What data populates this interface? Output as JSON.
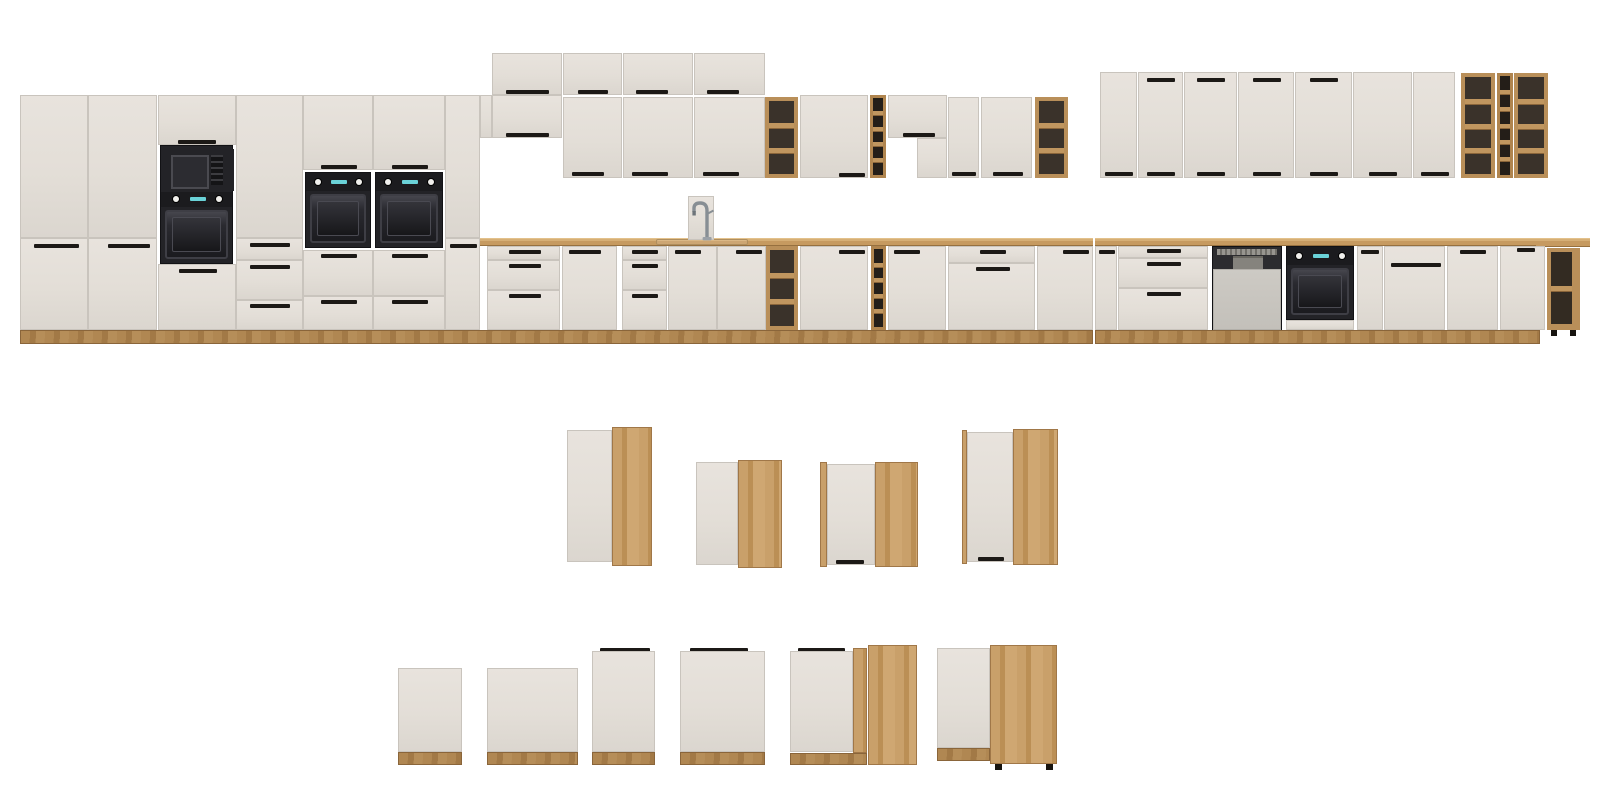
{
  "meta": {
    "scene": "kitchen-cabinet-modular-lineup-render",
    "width": 1600,
    "height": 807
  },
  "palette": {
    "background": "#ffffff",
    "front": "#e3ded7",
    "front_edge": "#c9c4bd",
    "wood_oak": "#c49a62",
    "countertop": "#c69a60",
    "plinth": "#a87f4e",
    "shelf_interior": "#3a322a",
    "winerack_interior": "#241e18",
    "handle": "#1c1916",
    "appliance_dark": "#232327",
    "oven_window": "#1b1b1f",
    "knob": "#f0efec",
    "display_cyan": "#6ad2d8",
    "dishwasher_panel": "#c9c6c0",
    "chrome": "#8e959b"
  },
  "modules": [
    {
      "n": "tall-side-panel",
      "t": "sidepanel",
      "x": 480,
      "y": 95,
      "w": 12,
      "h": 43
    },
    {
      "n": "tall-door",
      "t": "panel",
      "x": 20,
      "y": 95,
      "w": 68,
      "h": 143
    },
    {
      "n": "tall-door",
      "t": "panel",
      "x": 20,
      "y": 238,
      "w": 68,
      "h": 92,
      "hd": [
        [
          13,
          5,
          45
        ]
      ]
    },
    {
      "n": "tall-door",
      "t": "panel",
      "x": 88,
      "y": 95,
      "w": 69,
      "h": 143
    },
    {
      "n": "tall-door",
      "t": "panel",
      "x": 88,
      "y": 238,
      "w": 69,
      "h": 92,
      "hd": [
        [
          19,
          5,
          42
        ]
      ]
    },
    {
      "n": "tall-door",
      "t": "panel",
      "x": 158,
      "y": 95,
      "w": 78,
      "h": 50,
      "hd": [
        [
          19,
          44,
          38
        ]
      ]
    },
    {
      "n": "microwave-oven-tower",
      "t": "mt",
      "x": 160,
      "y": 145,
      "w": 73,
      "h": 119
    },
    {
      "n": "drawer-front",
      "t": "panel",
      "x": 158,
      "y": 264,
      "w": 78,
      "h": 66,
      "hd": [
        [
          20,
          4,
          38
        ]
      ]
    },
    {
      "n": "tall-door",
      "t": "panel",
      "x": 236,
      "y": 95,
      "w": 67,
      "h": 143
    },
    {
      "n": "drawer-front",
      "t": "panel",
      "x": 236,
      "y": 238,
      "w": 67,
      "h": 22,
      "hd": [
        [
          13,
          4,
          40
        ]
      ]
    },
    {
      "n": "drawer-front",
      "t": "panel",
      "x": 236,
      "y": 260,
      "w": 67,
      "h": 40,
      "hd": [
        [
          13,
          4,
          40
        ]
      ]
    },
    {
      "n": "drawer-front",
      "t": "panel",
      "x": 236,
      "y": 300,
      "w": 67,
      "h": 30,
      "hd": [
        [
          13,
          3,
          40
        ]
      ]
    },
    {
      "n": "tall-door",
      "t": "panel",
      "x": 303,
      "y": 95,
      "w": 70,
      "h": 75,
      "hd": [
        [
          17,
          69,
          36
        ]
      ]
    },
    {
      "n": "built-in-oven",
      "t": "ov",
      "x": 305,
      "y": 172,
      "w": 66,
      "h": 76
    },
    {
      "n": "drawer-front",
      "t": "panel",
      "x": 303,
      "y": 250,
      "w": 70,
      "h": 46,
      "hd": [
        [
          17,
          3,
          36
        ]
      ]
    },
    {
      "n": "drawer-front",
      "t": "panel",
      "x": 303,
      "y": 296,
      "w": 70,
      "h": 34,
      "hd": [
        [
          17,
          3,
          36
        ]
      ]
    },
    {
      "n": "tall-door",
      "t": "panel",
      "x": 373,
      "y": 95,
      "w": 72,
      "h": 75,
      "hd": [
        [
          18,
          69,
          36
        ]
      ]
    },
    {
      "n": "built-in-oven",
      "t": "ov",
      "x": 375,
      "y": 172,
      "w": 68,
      "h": 76
    },
    {
      "n": "drawer-front",
      "t": "panel",
      "x": 373,
      "y": 250,
      "w": 72,
      "h": 46,
      "hd": [
        [
          18,
          3,
          36
        ]
      ]
    },
    {
      "n": "drawer-front",
      "t": "panel",
      "x": 373,
      "y": 296,
      "w": 72,
      "h": 34,
      "hd": [
        [
          18,
          3,
          36
        ]
      ]
    },
    {
      "n": "tall-door",
      "t": "panel",
      "x": 445,
      "y": 95,
      "w": 35,
      "h": 143
    },
    {
      "n": "tall-door",
      "t": "panel",
      "x": 445,
      "y": 238,
      "w": 35,
      "h": 92,
      "hd": [
        [
          4,
          5,
          27
        ]
      ]
    },
    {
      "n": "wall-topper-door",
      "t": "panel",
      "x": 492,
      "y": 53,
      "w": 70,
      "h": 42,
      "hd": [
        [
          13,
          36,
          43
        ]
      ]
    },
    {
      "n": "wall-topper-door",
      "t": "panel",
      "x": 563,
      "y": 53,
      "w": 59,
      "h": 42,
      "hd": [
        [
          14,
          36,
          30
        ]
      ]
    },
    {
      "n": "wall-topper-door",
      "t": "panel",
      "x": 623,
      "y": 53,
      "w": 70,
      "h": 42,
      "hd": [
        [
          12,
          36,
          32
        ]
      ]
    },
    {
      "n": "wall-topper-door",
      "t": "panel",
      "x": 694,
      "y": 53,
      "w": 71,
      "h": 42,
      "hd": [
        [
          12,
          36,
          32
        ]
      ]
    },
    {
      "n": "wall-short-door",
      "t": "panel",
      "x": 492,
      "y": 95,
      "w": 70,
      "h": 43,
      "hd": [
        [
          13,
          37,
          43
        ]
      ]
    },
    {
      "n": "wall-door",
      "t": "panel",
      "x": 563,
      "y": 97,
      "w": 59,
      "h": 81,
      "hd": [
        [
          8,
          74,
          32
        ]
      ]
    },
    {
      "n": "wall-door",
      "t": "panel",
      "x": 623,
      "y": 97,
      "w": 70,
      "h": 81,
      "hd": [
        [
          8,
          74,
          36
        ]
      ]
    },
    {
      "n": "wall-door",
      "t": "panel",
      "x": 694,
      "y": 97,
      "w": 71,
      "h": 81,
      "hd": [
        [
          8,
          74,
          36
        ]
      ]
    },
    {
      "n": "wall-open-shelf",
      "t": "sh",
      "x": 765,
      "y": 97,
      "w": 33,
      "h": 81,
      "c": 3
    },
    {
      "n": "wall-door",
      "t": "panel",
      "x": 800,
      "y": 95,
      "w": 68,
      "h": 83,
      "hd": [
        [
          38,
          77,
          26
        ]
      ]
    },
    {
      "n": "wall-wine-rack",
      "t": "wr",
      "x": 870,
      "y": 95,
      "w": 16,
      "h": 83,
      "c": 5
    },
    {
      "n": "hood-cabinet-door",
      "t": "panel",
      "x": 888,
      "y": 95,
      "w": 59,
      "h": 43,
      "hd": [
        [
          14,
          37,
          32
        ]
      ]
    },
    {
      "n": "hood-cabinet-side",
      "t": "panel",
      "x": 917,
      "y": 138,
      "w": 30,
      "h": 40
    },
    {
      "n": "wall-door",
      "t": "panel",
      "x": 948,
      "y": 97,
      "w": 31,
      "h": 81,
      "hd": [
        [
          3,
          74,
          24
        ]
      ]
    },
    {
      "n": "wall-door",
      "t": "panel",
      "x": 981,
      "y": 97,
      "w": 51,
      "h": 81,
      "hd": [
        [
          11,
          74,
          30
        ]
      ]
    },
    {
      "n": "wall-open-shelf",
      "t": "sh",
      "x": 1035,
      "y": 97,
      "w": 33,
      "h": 81,
      "c": 3
    },
    {
      "n": "wall-door",
      "t": "panel",
      "x": 1100,
      "y": 72,
      "w": 37,
      "h": 106,
      "hd": [
        [
          4,
          99,
          28
        ]
      ]
    },
    {
      "n": "wall-door",
      "t": "panel",
      "x": 1138,
      "y": 72,
      "w": 45,
      "h": 106,
      "hd": [
        [
          8,
          99,
          28
        ],
        [
          8,
          5,
          28
        ]
      ]
    },
    {
      "n": "wall-door",
      "t": "panel",
      "x": 1184,
      "y": 72,
      "w": 53,
      "h": 106,
      "hd": [
        [
          12,
          99,
          28
        ],
        [
          12,
          5,
          28
        ]
      ]
    },
    {
      "n": "wall-door",
      "t": "panel",
      "x": 1238,
      "y": 72,
      "w": 56,
      "h": 106,
      "hd": [
        [
          14,
          99,
          28
        ],
        [
          14,
          5,
          28
        ]
      ]
    },
    {
      "n": "wall-door",
      "t": "panel",
      "x": 1295,
      "y": 72,
      "w": 57,
      "h": 106,
      "hd": [
        [
          14,
          99,
          28
        ],
        [
          14,
          5,
          28
        ]
      ]
    },
    {
      "n": "wall-door",
      "t": "panel",
      "x": 1353,
      "y": 72,
      "w": 59,
      "h": 106,
      "hd": [
        [
          15,
          99,
          28
        ]
      ]
    },
    {
      "n": "wall-door",
      "t": "panel",
      "x": 1413,
      "y": 72,
      "w": 42,
      "h": 106,
      "hd": [
        [
          7,
          99,
          28
        ]
      ]
    },
    {
      "n": "wall-open-shelf",
      "t": "sh",
      "x": 1461,
      "y": 73,
      "w": 34,
      "h": 105,
      "c": 4
    },
    {
      "n": "wall-wine-rack",
      "t": "wr",
      "x": 1497,
      "y": 73,
      "w": 16,
      "h": 105,
      "c": 6
    },
    {
      "n": "wall-open-shelf",
      "t": "sh",
      "x": 1514,
      "y": 73,
      "w": 34,
      "h": 105,
      "c": 4
    },
    {
      "n": "countertop",
      "t": "ct",
      "x": 480,
      "y": 238,
      "w": 613,
      "h": 8
    },
    {
      "n": "countertop",
      "t": "ct",
      "x": 1095,
      "y": 238,
      "w": 445,
      "h": 8
    },
    {
      "n": "corner-countertop",
      "t": "ct",
      "x": 1536,
      "y": 238,
      "w": 54,
      "h": 9
    },
    {
      "n": "sink-rim",
      "t": "sk",
      "x": 656,
      "y": 239,
      "w": 92,
      "h": 6
    },
    {
      "n": "faucet",
      "t": "fc",
      "x": 688,
      "y": 196,
      "w": 26,
      "h": 44
    },
    {
      "n": "drawer-front",
      "t": "panel",
      "x": 487,
      "y": 246,
      "w": 73,
      "h": 14,
      "hd": [
        [
          21,
          3,
          32
        ]
      ]
    },
    {
      "n": "drawer-front",
      "t": "panel",
      "x": 487,
      "y": 260,
      "w": 73,
      "h": 30,
      "hd": [
        [
          21,
          3,
          32
        ]
      ]
    },
    {
      "n": "drawer-front",
      "t": "panel",
      "x": 487,
      "y": 290,
      "w": 73,
      "h": 40,
      "hd": [
        [
          21,
          3,
          32
        ]
      ]
    },
    {
      "n": "base-door",
      "t": "panel",
      "x": 562,
      "y": 246,
      "w": 55,
      "h": 84,
      "hd": [
        [
          6,
          3,
          32
        ]
      ]
    },
    {
      "n": "drawer-front",
      "t": "panel",
      "x": 622,
      "y": 246,
      "w": 45,
      "h": 14,
      "hd": [
        [
          9,
          3,
          26
        ]
      ]
    },
    {
      "n": "drawer-front",
      "t": "panel",
      "x": 622,
      "y": 260,
      "w": 45,
      "h": 30,
      "hd": [
        [
          9,
          3,
          26
        ]
      ]
    },
    {
      "n": "drawer-front",
      "t": "panel",
      "x": 622,
      "y": 290,
      "w": 45,
      "h": 40,
      "hd": [
        [
          9,
          3,
          26
        ]
      ]
    },
    {
      "n": "sink-base-door",
      "t": "panel",
      "x": 668,
      "y": 246,
      "w": 49,
      "h": 84,
      "hd": [
        [
          6,
          3,
          26
        ]
      ]
    },
    {
      "n": "sink-base-door",
      "t": "panel",
      "x": 717,
      "y": 246,
      "w": 49,
      "h": 84,
      "hd": [
        [
          18,
          3,
          26
        ]
      ]
    },
    {
      "n": "base-open-shelf",
      "t": "sh",
      "x": 766,
      "y": 246,
      "w": 32,
      "h": 84,
      "c": 3
    },
    {
      "n": "base-door",
      "t": "panel",
      "x": 800,
      "y": 246,
      "w": 68,
      "h": 84,
      "hd": [
        [
          38,
          3,
          26
        ]
      ]
    },
    {
      "n": "base-wine-rack",
      "t": "wr",
      "x": 871,
      "y": 246,
      "w": 15,
      "h": 84,
      "c": 5
    },
    {
      "n": "base-door",
      "t": "panel",
      "x": 888,
      "y": 246,
      "w": 58,
      "h": 84,
      "hd": [
        [
          5,
          3,
          26
        ]
      ]
    },
    {
      "n": "drawer-front",
      "t": "panel",
      "x": 948,
      "y": 246,
      "w": 87,
      "h": 17,
      "hd": [
        [
          31,
          3,
          26
        ]
      ]
    },
    {
      "n": "base-front",
      "t": "panel",
      "x": 948,
      "y": 263,
      "w": 87,
      "h": 67,
      "hd": [
        [
          27,
          3,
          34
        ]
      ]
    },
    {
      "n": "base-door",
      "t": "panel",
      "x": 1037,
      "y": 246,
      "w": 56,
      "h": 84,
      "hd": [
        [
          25,
          3,
          26
        ]
      ]
    },
    {
      "n": "base-door",
      "t": "panel",
      "x": 1095,
      "y": 246,
      "w": 22,
      "h": 84,
      "hd": [
        [
          3,
          3,
          16
        ]
      ]
    },
    {
      "n": "drawer-front",
      "t": "panel",
      "x": 1118,
      "y": 246,
      "w": 90,
      "h": 12,
      "hd": [
        [
          28,
          2,
          34
        ]
      ]
    },
    {
      "n": "drawer-front",
      "t": "panel",
      "x": 1118,
      "y": 258,
      "w": 90,
      "h": 30,
      "hd": [
        [
          28,
          3,
          34
        ]
      ]
    },
    {
      "n": "drawer-front",
      "t": "panel",
      "x": 1118,
      "y": 288,
      "w": 90,
      "h": 42,
      "hd": [
        [
          28,
          3,
          34
        ]
      ]
    },
    {
      "n": "dishwasher",
      "t": "dw",
      "x": 1212,
      "y": 246,
      "w": 70,
      "h": 85
    },
    {
      "n": "built-in-oven",
      "t": "ov",
      "x": 1286,
      "y": 246,
      "w": 68,
      "h": 74
    },
    {
      "n": "base-front",
      "t": "panel",
      "x": 1286,
      "y": 320,
      "w": 68,
      "h": 10
    },
    {
      "n": "base-door",
      "t": "panel",
      "x": 1357,
      "y": 246,
      "w": 26,
      "h": 84,
      "hd": [
        [
          3,
          3,
          18
        ]
      ]
    },
    {
      "n": "appliance-front-panel",
      "t": "panel",
      "x": 1384,
      "y": 246,
      "w": 61,
      "h": 84,
      "hd": [
        [
          6,
          16,
          50
        ]
      ]
    },
    {
      "n": "base-door",
      "t": "panel",
      "x": 1447,
      "y": 246,
      "w": 51,
      "h": 84,
      "hd": [
        [
          12,
          3,
          26
        ]
      ]
    },
    {
      "n": "base-door",
      "t": "panel",
      "x": 1500,
      "y": 246,
      "w": 45,
      "h": 84,
      "hd": [
        [
          16,
          1,
          18
        ]
      ]
    },
    {
      "n": "corner-open-shelf",
      "t": "cs",
      "x": 1547,
      "y": 248,
      "w": 33,
      "h": 82,
      "c": 2
    },
    {
      "n": "adjustable-foot",
      "t": "ft",
      "x": 1551,
      "y": 330,
      "w": 6,
      "h": 6
    },
    {
      "n": "adjustable-foot",
      "t": "ft",
      "x": 1570,
      "y": 330,
      "w": 6,
      "h": 6
    },
    {
      "n": "plinth",
      "t": "pl",
      "x": 20,
      "y": 330,
      "w": 1073,
      "h": 14
    },
    {
      "n": "plinth",
      "t": "pl",
      "x": 1095,
      "y": 330,
      "w": 445,
      "h": 14
    },
    {
      "n": "corner-wall-wood-panel",
      "t": "woodv",
      "x": 612,
      "y": 427,
      "w": 40,
      "h": 139
    },
    {
      "n": "corner-wall-door",
      "t": "panel",
      "x": 567,
      "y": 430,
      "w": 45,
      "h": 132
    },
    {
      "n": "corner-wall-door",
      "t": "panel",
      "x": 696,
      "y": 462,
      "w": 42,
      "h": 103
    },
    {
      "n": "corner-wall-wood-panel",
      "t": "woodv",
      "x": 738,
      "y": 460,
      "w": 44,
      "h": 108
    },
    {
      "n": "corner-wall-wood-strip",
      "t": "woodv",
      "x": 820,
      "y": 462,
      "w": 7,
      "h": 105
    },
    {
      "n": "corner-wall-door",
      "t": "panel",
      "x": 827,
      "y": 464,
      "w": 48,
      "h": 101,
      "hd": [
        [
          8,
          95,
          28
        ]
      ]
    },
    {
      "n": "corner-wall-wood-panel",
      "t": "woodv",
      "x": 875,
      "y": 462,
      "w": 43,
      "h": 105
    },
    {
      "n": "corner-wall-wood-strip",
      "t": "woodv",
      "x": 962,
      "y": 430,
      "w": 5,
      "h": 134
    },
    {
      "n": "corner-wall-door",
      "t": "panel",
      "x": 967,
      "y": 432,
      "w": 46,
      "h": 130,
      "hd": [
        [
          10,
          124,
          26
        ]
      ]
    },
    {
      "n": "corner-wall-wood-panel",
      "t": "woodv",
      "x": 1013,
      "y": 429,
      "w": 45,
      "h": 136
    },
    {
      "n": "appliance-front-panel",
      "t": "panel",
      "x": 398,
      "y": 668,
      "w": 64,
      "h": 84
    },
    {
      "n": "front-plinth",
      "t": "pl",
      "x": 398,
      "y": 752,
      "w": 64,
      "h": 13
    },
    {
      "n": "appliance-front-panel",
      "t": "panel",
      "x": 487,
      "y": 668,
      "w": 91,
      "h": 84
    },
    {
      "n": "front-plinth",
      "t": "pl",
      "x": 487,
      "y": 752,
      "w": 91,
      "h": 13
    },
    {
      "n": "top-handle-bar",
      "t": "bar",
      "x": 600,
      "y": 648,
      "w": 50,
      "h": 5
    },
    {
      "n": "appliance-front-panel",
      "t": "panel",
      "x": 592,
      "y": 651,
      "w": 63,
      "h": 101
    },
    {
      "n": "front-plinth",
      "t": "pl",
      "x": 592,
      "y": 752,
      "w": 63,
      "h": 13
    },
    {
      "n": "top-handle-bar",
      "t": "bar",
      "x": 690,
      "y": 648,
      "w": 58,
      "h": 5
    },
    {
      "n": "appliance-front-panel",
      "t": "panel",
      "x": 680,
      "y": 651,
      "w": 85,
      "h": 101
    },
    {
      "n": "front-plinth",
      "t": "pl",
      "x": 680,
      "y": 752,
      "w": 85,
      "h": 13
    },
    {
      "n": "top-handle-bar",
      "t": "bar",
      "x": 798,
      "y": 648,
      "w": 47,
      "h": 5
    },
    {
      "n": "corner-base-door",
      "t": "panel",
      "x": 790,
      "y": 651,
      "w": 63,
      "h": 101
    },
    {
      "n": "corner-base-wood-strip",
      "t": "woodv",
      "x": 853,
      "y": 648,
      "w": 14,
      "h": 105
    },
    {
      "n": "front-plinth",
      "t": "pl",
      "x": 790,
      "y": 753,
      "w": 77,
      "h": 12
    },
    {
      "n": "corner-base-wood-panel",
      "t": "woodv",
      "x": 868,
      "y": 645,
      "w": 49,
      "h": 120
    },
    {
      "n": "corner-base-door",
      "t": "panel",
      "x": 937,
      "y": 648,
      "w": 53,
      "h": 100
    },
    {
      "n": "front-plinth",
      "t": "pl",
      "x": 937,
      "y": 748,
      "w": 53,
      "h": 13
    },
    {
      "n": "corner-base-wood-panel",
      "t": "woodv",
      "x": 990,
      "y": 645,
      "w": 67,
      "h": 119
    },
    {
      "n": "adjustable-foot",
      "t": "ft",
      "x": 995,
      "y": 764,
      "w": 7,
      "h": 6
    },
    {
      "n": "adjustable-foot",
      "t": "ft",
      "x": 1046,
      "y": 764,
      "w": 7,
      "h": 6
    }
  ]
}
